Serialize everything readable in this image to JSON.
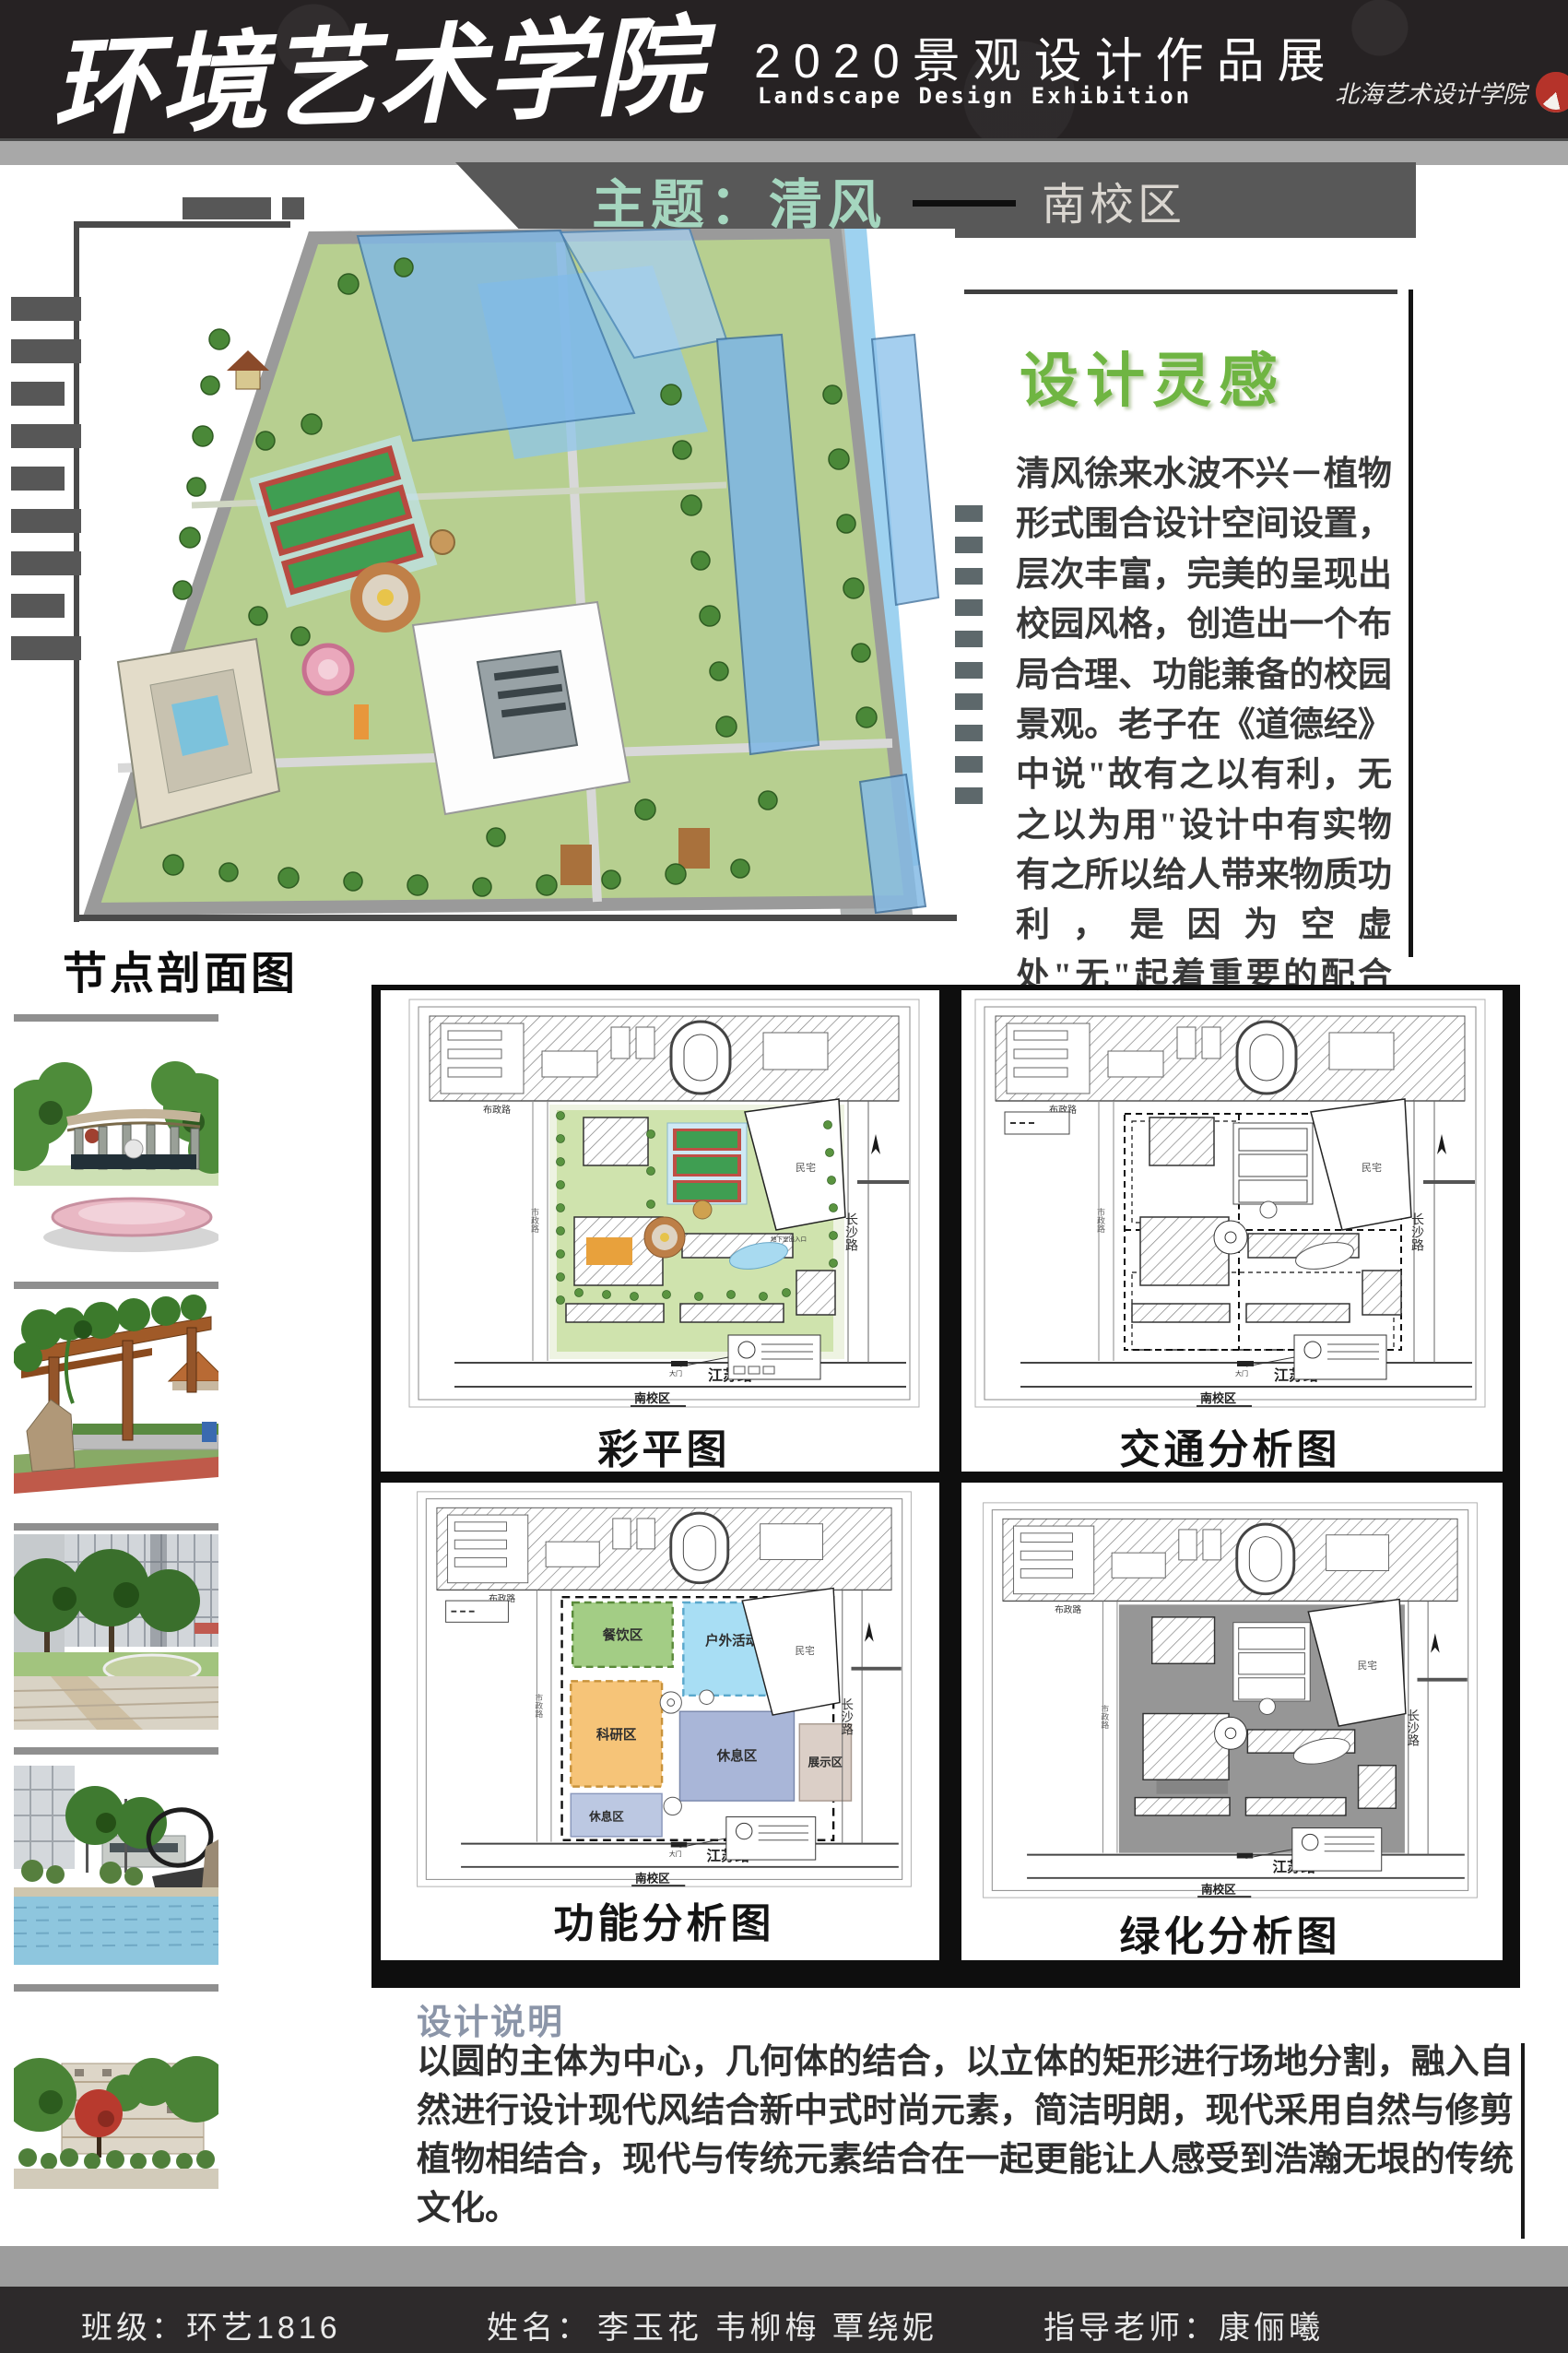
{
  "header": {
    "school": "环境艺术学院",
    "exhibition_cn": "2020景观设计作品展",
    "exhibition_en": "Landscape Design Exhibition",
    "logo_text": "北海艺术设计学院"
  },
  "banner": {
    "title": "主题：清风",
    "campus": "南校区"
  },
  "inspiration": {
    "title": "设计灵感",
    "body": "清风徐来水波不兴－植物形式围合设计空间设置，层次丰富，完美的呈现出校园风格，创造出一个布局合理、功能兼备的校园景观。老子在《道德经》中说\"故有之以有利，无之以为用\"设计中有实物有之所以给人带来物质功利，是因为空虚处\"无\"起着重要的配合作用。"
  },
  "sections": {
    "node_profile": "节点剖面图"
  },
  "plans": {
    "labels": {
      "caiping": "彩平图",
      "jiaotong": "交通分析图",
      "gongneng": "功能分析图",
      "lvhua": "绿化分析图"
    },
    "roads": {
      "buzheng": "布政路",
      "changsha": "长沙路",
      "jiangsu": "江苏路",
      "shizheng": "市政路",
      "minzhai": "民宅",
      "campus": "南校区",
      "gate": "大门",
      "basement": "地下室出入口"
    },
    "zones": [
      "餐饮区",
      "户外活动区",
      "科研区",
      "休息区",
      "展示区",
      "休息区"
    ]
  },
  "description": {
    "title": "设计说明",
    "body": "以圆的主体为中心，几何体的结合，以立体的矩形进行场地分割，融入自然进行设计现代风结合新中式时尚元素，简洁明朗，现代采用自然与修剪植物相结合，现代与传统元素结合在一起更能让人感受到浩瀚无垠的传统文化。"
  },
  "footer": {
    "class_info": "班级：环艺1816",
    "name_label": "姓名：",
    "names": "李玉花  韦柳梅  覃绕妮",
    "advisor": "指导老师：康俪曦"
  },
  "colors": {
    "mint": "#a5d6bf",
    "title_green": "#6fb542",
    "desc_heading": "#8b95a8",
    "footer_bg": "#2d2a2b",
    "logo_red": "#b5332a"
  }
}
